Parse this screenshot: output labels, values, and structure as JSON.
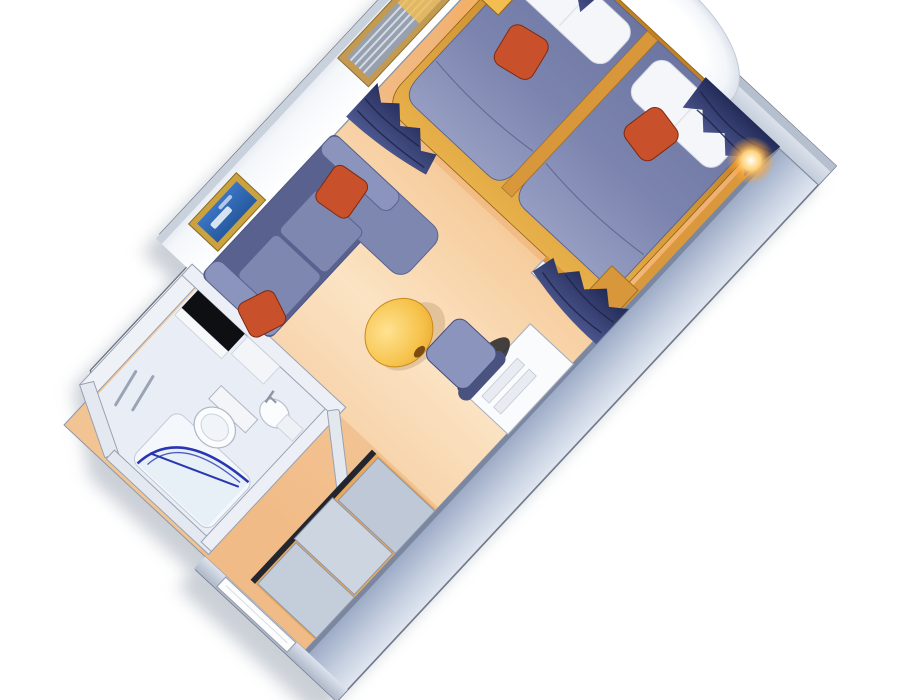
{
  "title": "stateroom-3d-floorplan",
  "colors": {
    "background": "#ffffff",
    "carpet": "#f5cfa0",
    "carpet_light": "#fbe3c3",
    "carpet_bedroom": "#eeac6e",
    "carpet_corridor": "#eeb57e",
    "wall_face": "#f7f9fc",
    "wall_edge": "#c9d1dd",
    "wall_line": "#8b94a4",
    "outline": "#6a7382",
    "exterior_wall": "#a9b7d0",
    "exterior_wall_light": "#e3e9f3",
    "gold": "#d8973a",
    "gold_light": "#f3bd52",
    "gold_dark": "#a4701e",
    "navy_headboard": "#2a3161",
    "curtain": "#3e4a85",
    "curtain_dark": "#232b58",
    "fabric": "#7e87b0",
    "fabric_dark": "#59618f",
    "fabric_light": "#8b94bd",
    "accent_red": "#c8512c",
    "accent_red_dark": "#7e2a10",
    "pillow_white": "#f4f6fa",
    "table_yellow": "#f6c24a",
    "picture_blue": "#2f67b8",
    "frame_gold": "#caa23f",
    "shower_blue": "#2836b2",
    "counter_black": "#0e0f13",
    "closet_panel": "#c4cdda",
    "groove_dark": "#23262e",
    "door_white": "#fdfdfe",
    "glow_warm": "#ffd27a",
    "window_glow": "#ffffff"
  },
  "rooms": {
    "bedroom": {
      "items": [
        "twin-bed-left",
        "twin-bed-right",
        "white-pillows",
        "red-accent-cushions",
        "gold-nightstand",
        "navy-headboard",
        "oval-window-glow",
        "window-curtains",
        "wall-sconces",
        "gold-bench"
      ]
    },
    "sitting_area": {
      "items": [
        "sofa",
        "red-sofa-pillows",
        "round-coffee-table",
        "desk",
        "desk-chair",
        "wall-picture",
        "blinds-mirror-panel",
        "divider-curtains"
      ]
    },
    "bathroom": {
      "items": [
        "shower-arc-door",
        "toilet",
        "pedestal-sink",
        "black-counter",
        "towel-bars"
      ]
    },
    "entry": {
      "items": [
        "entry-door",
        "closet-sliding-doors",
        "bathroom-door"
      ]
    }
  }
}
